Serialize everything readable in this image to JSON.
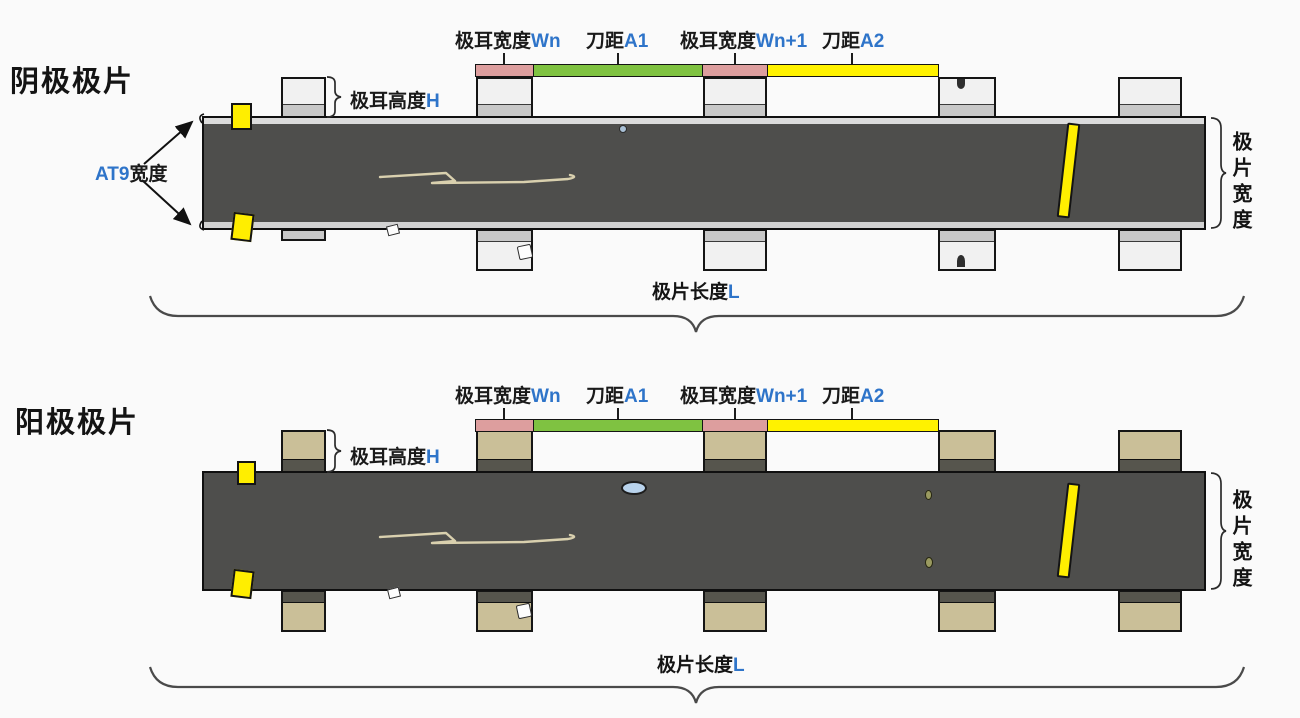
{
  "colors": {
    "background": "#fafafa",
    "strip": "#4e4e4c",
    "strip_edge_band": "#dcdcdc",
    "cathode_tab_body": "#f1f1f1",
    "cathode_tab_band": "#c8c8c8",
    "anode_tab_body": "#cabf98",
    "anode_tab_band": "#56554d",
    "bar_pink": "#dd9e9e",
    "bar_green": "#7fc241",
    "bar_yellow": "#fff200",
    "marker_yellow": "#ffee00",
    "accent_blue": "#2e74c9",
    "text": "#141414"
  },
  "diagrams": [
    {
      "title": "阴极极片",
      "annotations": {
        "tab_width_n": {
          "text": "极耳宽度",
          "var": "Wn"
        },
        "pitch_a1": {
          "text": "刀距",
          "var": "A1"
        },
        "tab_width_n1": {
          "text": "极耳宽度",
          "var": "Wn+1"
        },
        "pitch_a2": {
          "text": "刀距",
          "var": "A2"
        },
        "tab_height": {
          "text": "极耳高度",
          "var": "H"
        },
        "at9": {
          "var": "AT9",
          "text": "宽度"
        },
        "sheet_width": "极片宽度",
        "sheet_length": {
          "text": "极片长度",
          "var": "L"
        }
      }
    },
    {
      "title": "阳极极片",
      "annotations": {
        "tab_width_n": {
          "text": "极耳宽度",
          "var": "Wn"
        },
        "pitch_a1": {
          "text": "刀距",
          "var": "A1"
        },
        "tab_width_n1": {
          "text": "极耳宽度",
          "var": "Wn+1"
        },
        "pitch_a2": {
          "text": "刀距",
          "var": "A2"
        },
        "tab_height": {
          "text": "极耳高度",
          "var": "H"
        },
        "sheet_width": "极片宽度",
        "sheet_length": {
          "text": "极片长度",
          "var": "L"
        }
      }
    }
  ]
}
